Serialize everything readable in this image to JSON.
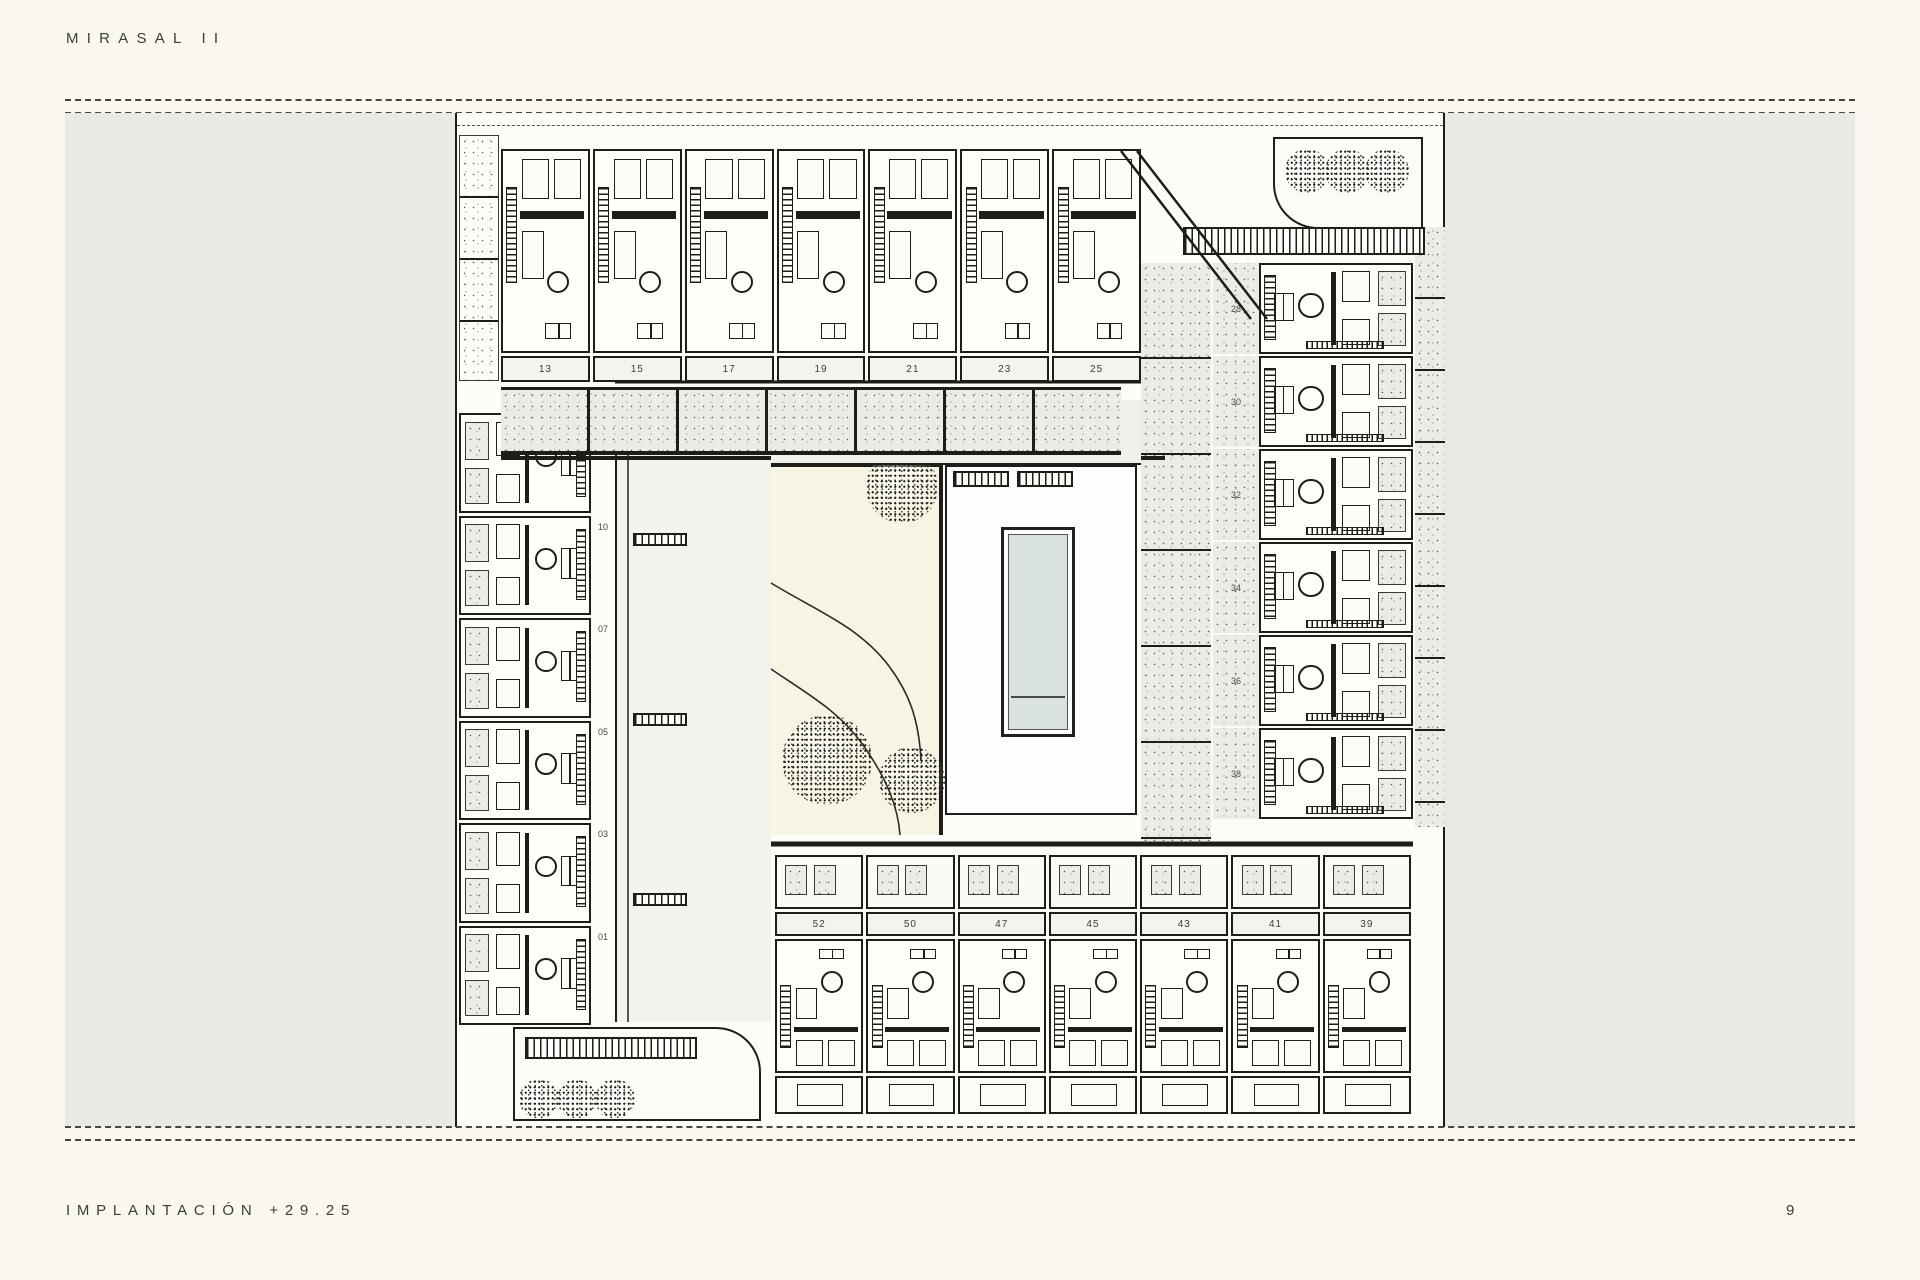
{
  "page": {
    "title": "MIRASAL II",
    "footer_label": "IMPLANTACIÓN +29.25",
    "page_number": "9"
  },
  "colors": {
    "background": "#FAF8EE",
    "band": "#E9E9E5",
    "paper": "#FCFCF8",
    "ink": "#1d1d1a",
    "pool": "#D9E2E1",
    "garden": "#F8F4E3"
  },
  "plan": {
    "top_row_units": [
      "13",
      "15",
      "17",
      "19",
      "21",
      "23",
      "25"
    ],
    "left_column_units": [
      "12",
      "10",
      "07",
      "05",
      "03",
      "01"
    ],
    "right_column_units": [
      "28",
      "30",
      "32",
      "34",
      "36",
      "38"
    ],
    "bottom_row_units": [
      "52",
      "50",
      "47",
      "45",
      "43",
      "41",
      "39"
    ]
  }
}
